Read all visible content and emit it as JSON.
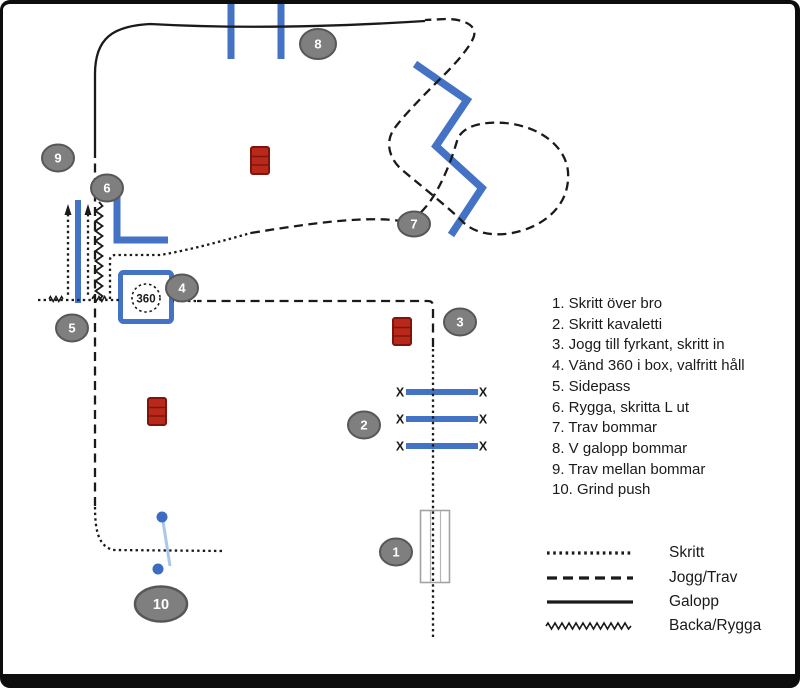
{
  "course_steps": [
    "1. Skritt över bro",
    "2. Skritt kavaletti",
    "3. Jogg till fyrkant, skritt in",
    "4. Vänd 360 i box, valfritt håll",
    "5. Sidepass",
    "6. Rygga, skritta L ut",
    "7. Trav bommar",
    "8. V galopp bommar",
    "9. Trav mellan bommar",
    "10. Grind push"
  ],
  "markers": [
    "1",
    "2",
    "3",
    "4",
    "5",
    "6",
    "7",
    "8",
    "9",
    "10"
  ],
  "obstacles": {
    "box_turn_label": "360",
    "kavaletti_end_marker": "X"
  },
  "legend": {
    "items": [
      {
        "line_style": "dotted",
        "label": "Skritt"
      },
      {
        "line_style": "dashed",
        "label": "Jogg/Trav"
      },
      {
        "line_style": "solid",
        "label": "Galopp"
      },
      {
        "line_style": "zigzag",
        "label": "Backa/Rygga"
      }
    ]
  },
  "colors": {
    "pole_blue": "#4472C4",
    "barrel_red": "#B8291B",
    "barrel_red_dark": "#7E150B",
    "badge_gray": "#7F7F7F",
    "badge_border": "#575757",
    "gate_line_light_blue": "#A9C7E9",
    "gate_dot_blue": "#3D6DC2",
    "bridge_gray": "#A3A3A3",
    "path_black": "#1A1A1A"
  }
}
